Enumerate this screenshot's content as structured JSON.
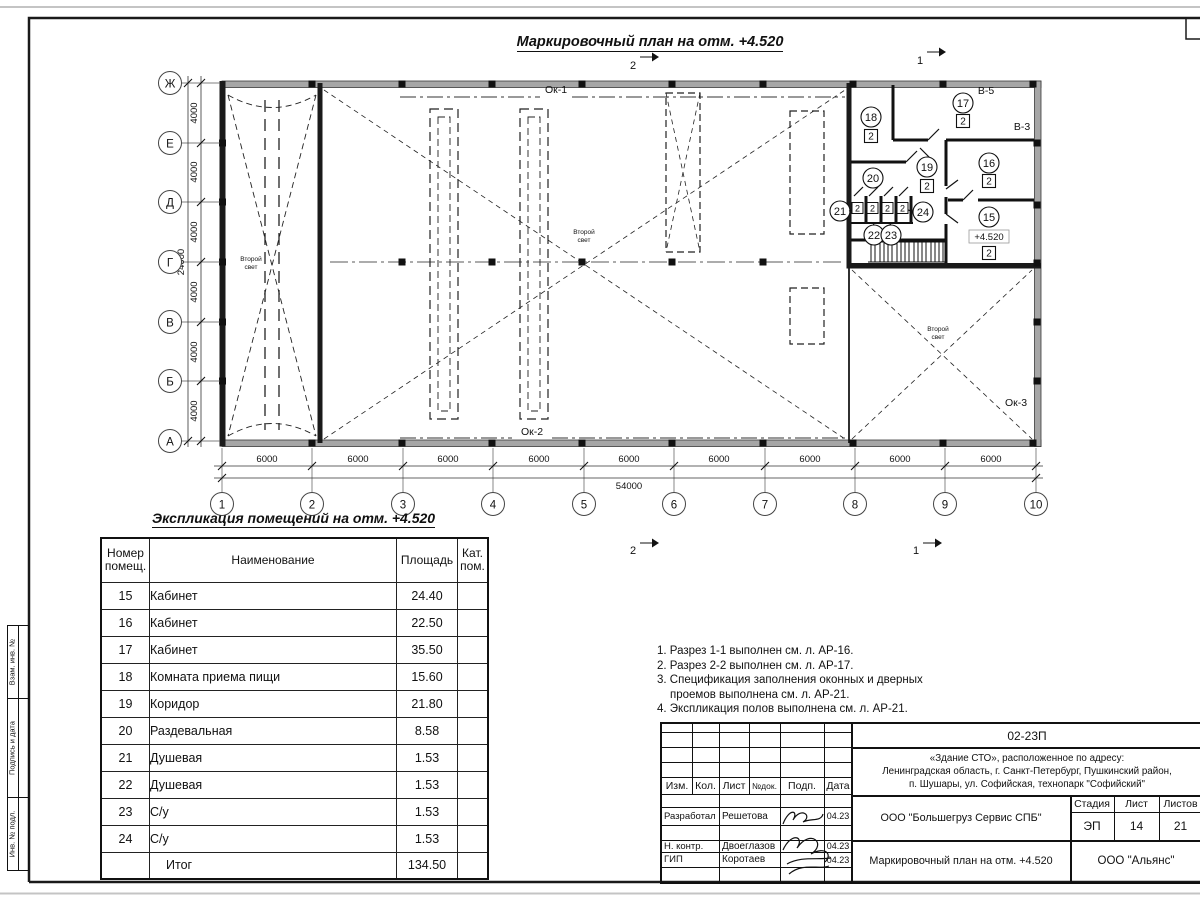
{
  "plan": {
    "title": "Маркировочный план на отм. +4.520",
    "axis_cols": [
      "1",
      "2",
      "3",
      "4",
      "5",
      "6",
      "7",
      "8",
      "9",
      "10"
    ],
    "axis_rows": [
      "Ж",
      "Е",
      "Д",
      "Г",
      "В",
      "Б",
      "А"
    ],
    "dim_w": "6000",
    "dim_w_total": "54000",
    "dim_h": "4000",
    "dim_h_total": "24000",
    "rooms": [
      "15",
      "16",
      "17",
      "18",
      "19",
      "20",
      "21",
      "22",
      "23",
      "24"
    ],
    "category": "2",
    "elevation": "+4.520",
    "window_1": "Ок-1",
    "window_2": "Ок-2",
    "window_3": "Ок-3",
    "vent_1": "В-5",
    "vent_2": "В-3",
    "second_light_line1": "Второй",
    "second_light_line2": "свет",
    "section_1": "1",
    "section_2": "2"
  },
  "explication": {
    "title": "Экспликация помещений на отм. +4.520",
    "headers": {
      "num": "Номер помещ.",
      "name": "Наименование",
      "area": "Площадь",
      "cat": "Кат. пом."
    },
    "rows": [
      {
        "num": "15",
        "name": "Кабинет",
        "area": "24.40"
      },
      {
        "num": "16",
        "name": "Кабинет",
        "area": "22.50"
      },
      {
        "num": "17",
        "name": "Кабинет",
        "area": "35.50"
      },
      {
        "num": "18",
        "name": "Комната приема пищи",
        "area": "15.60"
      },
      {
        "num": "19",
        "name": "Коридор",
        "area": "21.80"
      },
      {
        "num": "20",
        "name": "Раздевальная",
        "area": "8.58"
      },
      {
        "num": "21",
        "name": "Душевая",
        "area": "1.53"
      },
      {
        "num": "22",
        "name": "Душевая",
        "area": "1.53"
      },
      {
        "num": "23",
        "name": "С/у",
        "area": "1.53"
      },
      {
        "num": "24",
        "name": "С/у",
        "area": "1.53"
      }
    ],
    "total_label": "Итог",
    "total_value": "134.50"
  },
  "notes": {
    "line1": "1. Разрез 1-1 выполнен см. л. АР-16.",
    "line2": "2. Разрез 2-2 выполнен см. л. АР-17.",
    "line3a": "3. Спецификация заполнения оконных и дверных",
    "line3b": "проемов выполнена см. л. АР-21.",
    "line4": "4. Экспликация полов выполнена см. л. АР-21."
  },
  "stamp": {
    "code": "02-23П",
    "address_line1": "«Здание СТО», расположенное по адресу:",
    "address_line2": "Ленинградская область, г. Санкт-Петербург, Пушкинский район,",
    "address_line3": "п. Шушары, ул. Софийская, технопарк \"Софийский\"",
    "col_izm": "Изм.",
    "col_kol": "Кол.",
    "col_list": "Лист",
    "col_ndok": "№док.",
    "col_podp": "Подп.",
    "col_data": "Дата",
    "row1_role": "Разработал",
    "row1_name": "Решетова",
    "row1_date": "04.23",
    "row2_role": "Н. контр.",
    "row2_name": "Двоеглазов",
    "row2_date": "04.23",
    "row3_role": "ГИП",
    "row3_name": "Коротаев",
    "row3_date": "04.23",
    "company": "ООО \"Большегруз Сервис СПБ\"",
    "stage_label": "Стадия",
    "sheet_label": "Лист",
    "sheets_label": "Листов",
    "stage": "ЭП",
    "sheet_no": "14",
    "sheets_total": "21",
    "drawing_name": "Маркировочный план на отм. +4.520",
    "org": "ООО \"Альянс\""
  },
  "frame": {
    "label1": "Взам. инв. №",
    "label2": "Подпись и дата",
    "label3": "Инв. № подл."
  }
}
